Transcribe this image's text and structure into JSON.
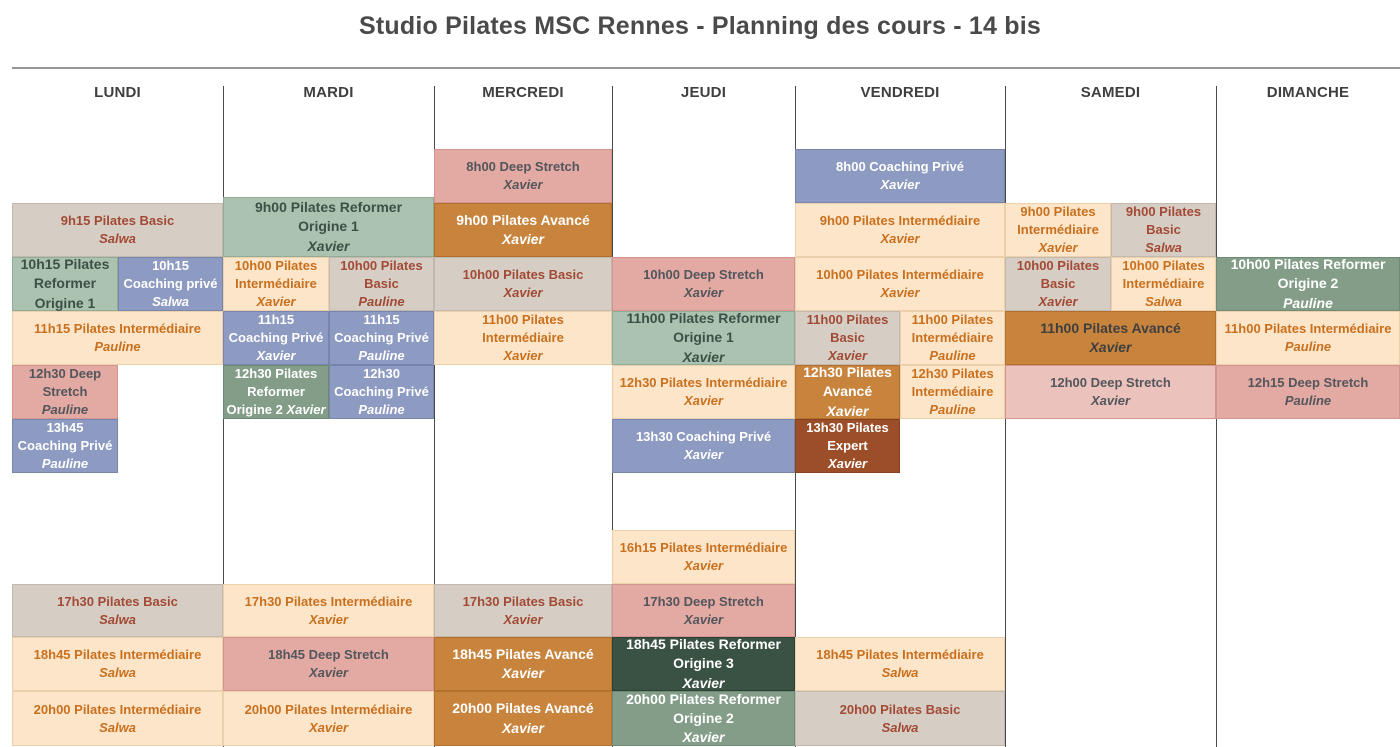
{
  "title": "Studio Pilates MSC Rennes - Planning des cours - 14 bis",
  "days": [
    "LUNDI",
    "MARDI",
    "MERCREDI",
    "JEUDI",
    "VENDREDI",
    "SAMEDI",
    "DIMANCHE"
  ],
  "categories": {
    "basic": {
      "label": "Pilates Basic",
      "bg": "#d6cec5",
      "border": "#c2b8ad",
      "text": "#a24a35"
    },
    "inter": {
      "label": "Pilates Intermédiaire",
      "bg": "#fce5c9",
      "border": "#ecd0ab",
      "text": "#c9701e"
    },
    "ref1": {
      "label": "Pilates Reformer Origine 1",
      "bg": "#abc2b0",
      "border": "#92ab97",
      "text": "#3d5045"
    },
    "ref2": {
      "label": "Pilates Reformer Origine 2",
      "bg": "#839d88",
      "border": "#6d8a73",
      "text": "#ffffff"
    },
    "ref3": {
      "label": "Pilates Reformer Origine 3",
      "bg": "#3a5244",
      "border": "#2d4034",
      "text": "#ffffff"
    },
    "avance": {
      "label": "Pilates Avancé",
      "bg": "#c8833c",
      "border": "#b26f2d",
      "text": "#ffffff"
    },
    "expert": {
      "label": "Pilates Expert",
      "bg": "#9c4e29",
      "border": "#86411f",
      "text": "#ffffff"
    },
    "deep": {
      "label": "Deep Stretch",
      "bg": "#e2aaa3",
      "border": "#d3958d",
      "text": "#53565c"
    },
    "coach": {
      "label": "Coaching Privé",
      "bg": "#8d9ac1",
      "border": "#7886ad",
      "text": "#ffffff"
    }
  },
  "events": [
    {
      "day": 0,
      "row": "B",
      "side": "full",
      "cat": "basic",
      "lines": [
        "9h15 Pilates Basic"
      ],
      "name": "Salwa"
    },
    {
      "day": 0,
      "row": "C",
      "side": "left",
      "cat": "ref1",
      "lines": [
        "10h15 Pilates",
        "Reformer",
        "Origine 1"
      ],
      "name": null
    },
    {
      "day": 0,
      "row": "C",
      "side": "right",
      "cat": "coach",
      "lines": [
        "10h15",
        "Coaching privé"
      ],
      "name": "Salwa"
    },
    {
      "day": 0,
      "row": "D",
      "side": "full",
      "cat": "inter",
      "lines": [
        "11h15 Pilates Intermédiaire"
      ],
      "name": "Pauline"
    },
    {
      "day": 0,
      "row": "E",
      "side": "left",
      "cat": "deep",
      "lines": [
        "12h30 Deep",
        "Stretch"
      ],
      "name": "Pauline"
    },
    {
      "day": 0,
      "row": "F",
      "side": "left",
      "cat": "coach",
      "lines": [
        "13h45",
        "Coaching Privé"
      ],
      "name": "Pauline"
    },
    {
      "day": 0,
      "row": "H",
      "side": "full",
      "cat": "basic",
      "lines": [
        "17h30 Pilates Basic"
      ],
      "name": "Salwa"
    },
    {
      "day": 0,
      "row": "I",
      "side": "full",
      "cat": "inter",
      "lines": [
        "18h45 Pilates Intermédiaire"
      ],
      "name": "Salwa"
    },
    {
      "day": 0,
      "row": "J",
      "side": "full",
      "cat": "inter",
      "lines": [
        "20h00 Pilates Intermédiaire"
      ],
      "name": "Salwa"
    },
    {
      "day": 1,
      "row": "B",
      "side": "full",
      "cat": "ref1",
      "lines": [
        "9h00 Pilates Reformer",
        "Origine 1"
      ],
      "name": "Xavier",
      "y": 197,
      "h": 60
    },
    {
      "day": 1,
      "row": "C",
      "side": "left",
      "cat": "inter",
      "lines": [
        "10h00 Pilates",
        "Intermédiaire"
      ],
      "name": "Xavier"
    },
    {
      "day": 1,
      "row": "C",
      "side": "right",
      "cat": "basic",
      "lines": [
        "10h00 Pilates",
        "Basic"
      ],
      "name": "Pauline"
    },
    {
      "day": 1,
      "row": "D",
      "side": "left",
      "cat": "coach",
      "lines": [
        "11h15",
        "Coaching Privé"
      ],
      "name": "Xavier"
    },
    {
      "day": 1,
      "row": "D",
      "side": "right",
      "cat": "coach",
      "lines": [
        "11h15",
        "Coaching Privé"
      ],
      "name": "Pauline"
    },
    {
      "day": 1,
      "row": "E",
      "side": "left",
      "cat": "ref2",
      "lines": [
        "12h30 Pilates",
        "Reformer",
        "Origine 2"
      ],
      "name": "Xavier",
      "name_inline": true,
      "fs": 13
    },
    {
      "day": 1,
      "row": "E",
      "side": "right",
      "cat": "coach",
      "lines": [
        "12h30",
        "Coaching Privé"
      ],
      "name": "Pauline"
    },
    {
      "day": 1,
      "row": "H",
      "side": "full",
      "cat": "inter",
      "lines": [
        "17h30 Pilates Intermédiaire"
      ],
      "name": "Xavier"
    },
    {
      "day": 1,
      "row": "I",
      "side": "full",
      "cat": "deep",
      "lines": [
        "18h45 Deep Stretch"
      ],
      "name": "Xavier"
    },
    {
      "day": 1,
      "row": "J",
      "side": "full",
      "cat": "inter",
      "lines": [
        "20h00 Pilates Intermédiaire"
      ],
      "name": "Xavier"
    },
    {
      "day": 2,
      "row": "A",
      "side": "full",
      "cat": "deep",
      "lines": [
        "8h00 Deep Stretch"
      ],
      "name": "Xavier"
    },
    {
      "day": 2,
      "row": "B",
      "side": "full",
      "cat": "avance",
      "lines": [
        "9h00 Pilates Avancé"
      ],
      "name": "Xavier"
    },
    {
      "day": 2,
      "row": "C",
      "side": "full",
      "cat": "basic",
      "lines": [
        "10h00 Pilates Basic"
      ],
      "name": "Xavier"
    },
    {
      "day": 2,
      "row": "D",
      "side": "full",
      "cat": "inter",
      "lines": [
        "11h00 Pilates",
        "Intermédiaire"
      ],
      "name": "Xavier"
    },
    {
      "day": 2,
      "row": "H",
      "side": "full",
      "cat": "basic",
      "lines": [
        "17h30 Pilates Basic"
      ],
      "name": "Xavier"
    },
    {
      "day": 2,
      "row": "I",
      "side": "full",
      "cat": "avance",
      "lines": [
        "18h45 Pilates Avancé"
      ],
      "name": "Xavier"
    },
    {
      "day": 2,
      "row": "J",
      "side": "full",
      "cat": "avance",
      "lines": [
        "20h00 Pilates Avancé"
      ],
      "name": "Xavier"
    },
    {
      "day": 3,
      "row": "C",
      "side": "full",
      "cat": "deep",
      "lines": [
        "10h00 Deep Stretch"
      ],
      "name": "Xavier"
    },
    {
      "day": 3,
      "row": "D",
      "side": "full",
      "cat": "ref1",
      "lines": [
        "11h00 Pilates Reformer",
        "Origine 1"
      ],
      "name": "Xavier"
    },
    {
      "day": 3,
      "row": "E",
      "side": "full",
      "cat": "inter",
      "lines": [
        "12h30 Pilates Intermédiaire"
      ],
      "name": "Xavier"
    },
    {
      "day": 3,
      "row": "F",
      "side": "full",
      "cat": "coach",
      "lines": [
        "13h30 Coaching Privé"
      ],
      "name": "Xavier"
    },
    {
      "day": 3,
      "row": "G",
      "side": "full",
      "cat": "inter",
      "lines": [
        "16h15 Pilates Intermédiaire"
      ],
      "name": "Xavier"
    },
    {
      "day": 3,
      "row": "H",
      "side": "full",
      "cat": "deep",
      "lines": [
        "17h30 Deep Stretch"
      ],
      "name": "Xavier"
    },
    {
      "day": 3,
      "row": "I",
      "side": "full",
      "cat": "ref3",
      "lines": [
        "18h45 Pilates Reformer",
        "Origine 3"
      ],
      "name": "Xavier"
    },
    {
      "day": 3,
      "row": "J",
      "side": "full",
      "cat": "ref2",
      "lines": [
        "20h00 Pilates Reformer",
        "Origine 2"
      ],
      "name": "Xavier"
    },
    {
      "day": 4,
      "row": "A",
      "side": "full",
      "cat": "coach",
      "lines": [
        "8h00 Coaching Privé"
      ],
      "name": "Xavier"
    },
    {
      "day": 4,
      "row": "B",
      "side": "full",
      "cat": "inter",
      "lines": [
        "9h00 Pilates Intermédiaire"
      ],
      "name": "Xavier"
    },
    {
      "day": 4,
      "row": "C",
      "side": "full",
      "cat": "inter",
      "lines": [
        "10h00 Pilates Intermédiaire"
      ],
      "name": "Xavier"
    },
    {
      "day": 4,
      "row": "D",
      "side": "left",
      "cat": "basic",
      "lines": [
        "11h00 Pilates",
        "Basic"
      ],
      "name": "Xavier"
    },
    {
      "day": 4,
      "row": "D",
      "side": "right",
      "cat": "inter",
      "lines": [
        "11h00 Pilates",
        "Intermédiaire"
      ],
      "name": "Pauline"
    },
    {
      "day": 4,
      "row": "E",
      "side": "left",
      "cat": "avance",
      "lines": [
        "12h30 Pilates",
        "Avancé"
      ],
      "name": "Xavier"
    },
    {
      "day": 4,
      "row": "E",
      "side": "right",
      "cat": "inter",
      "lines": [
        "12h30 Pilates",
        "Intermédiaire"
      ],
      "name": "Pauline"
    },
    {
      "day": 4,
      "row": "F",
      "side": "left",
      "cat": "expert",
      "lines": [
        "13h30 Pilates",
        "Expert"
      ],
      "name": "Xavier"
    },
    {
      "day": 4,
      "row": "I",
      "side": "full",
      "cat": "inter",
      "lines": [
        "18h45 Pilates Intermédiaire"
      ],
      "name": "Salwa"
    },
    {
      "day": 4,
      "row": "J",
      "side": "full",
      "cat": "basic",
      "lines": [
        "20h00 Pilates Basic"
      ],
      "name": "Salwa"
    },
    {
      "day": 5,
      "row": "B",
      "side": "left",
      "cat": "inter",
      "lines": [
        "9h00 Pilates",
        "Intermédiaire"
      ],
      "name": "Xavier"
    },
    {
      "day": 5,
      "row": "B",
      "side": "right",
      "cat": "basic",
      "lines": [
        "9h00 Pilates",
        "Basic"
      ],
      "name": "Salwa"
    },
    {
      "day": 5,
      "row": "C",
      "side": "left",
      "cat": "basic",
      "lines": [
        "10h00 Pilates",
        "Basic"
      ],
      "name": "Xavier"
    },
    {
      "day": 5,
      "row": "C",
      "side": "right",
      "cat": "inter",
      "lines": [
        "10h00 Pilates",
        "Intermédiaire"
      ],
      "name": "Salwa"
    },
    {
      "day": 5,
      "row": "D",
      "side": "full",
      "cat": "avance",
      "lines": [
        "11h00 Pilates Avancé"
      ],
      "name": "Xavier",
      "text_color": "#3f3f3f"
    },
    {
      "day": 5,
      "row": "E",
      "side": "full",
      "cat": "deep",
      "lines": [
        "12h00 Deep Stretch"
      ],
      "name": "Xavier",
      "bg_color": "#ecc3bc"
    },
    {
      "day": 6,
      "row": "C",
      "side": "full",
      "cat": "ref2",
      "lines": [
        "10h00 Pilates Reformer",
        "Origine 2"
      ],
      "name": "Pauline"
    },
    {
      "day": 6,
      "row": "D",
      "side": "full",
      "cat": "inter",
      "lines": [
        "11h00 Pilates Intermédiaire"
      ],
      "name": "Pauline"
    },
    {
      "day": 6,
      "row": "E",
      "side": "full",
      "cat": "deep",
      "lines": [
        "12h15 Deep Stretch"
      ],
      "name": "Pauline"
    }
  ]
}
